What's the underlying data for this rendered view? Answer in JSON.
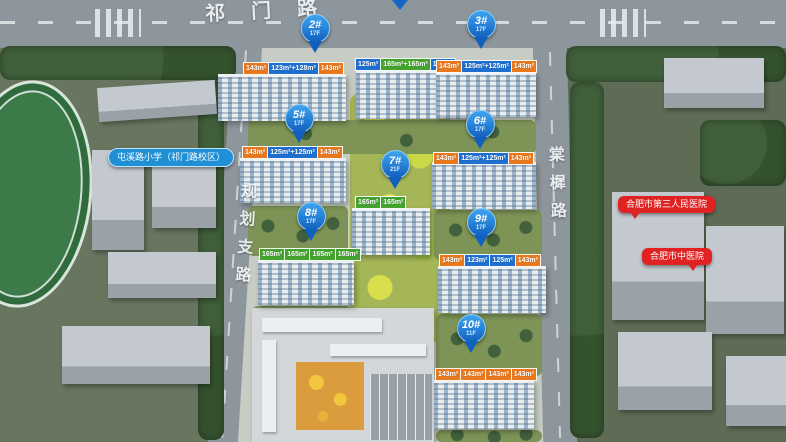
{
  "roads": {
    "top": "祁门路",
    "left": "规划支路",
    "right": "棠樨路"
  },
  "pois": {
    "school": "屯溪路小学（祁门路校区）",
    "hospital_1": "合肥市第三人民医院",
    "hospital_2": "合肥市中医院"
  },
  "buildings": [
    {
      "id": "1#",
      "tags": [
        {
          "text": "125m²",
          "color": "blue"
        },
        {
          "text": "165m²+165m²",
          "color": "green"
        },
        {
          "text": "125m²",
          "color": "blue"
        }
      ]
    },
    {
      "id": "2#",
      "floors": "17F",
      "tags": [
        {
          "text": "143m²",
          "color": "orange"
        },
        {
          "text": "123m²+128m²",
          "color": "blue"
        },
        {
          "text": "143m²",
          "color": "orange"
        }
      ]
    },
    {
      "id": "3#",
      "floors": "17F",
      "tags": [
        {
          "text": "143m²",
          "color": "orange"
        },
        {
          "text": "125m²+125m²",
          "color": "blue"
        },
        {
          "text": "143m²",
          "color": "orange"
        }
      ]
    },
    {
      "id": "5#",
      "floors": "17F",
      "tags": [
        {
          "text": "143m²",
          "color": "orange"
        },
        {
          "text": "125m²+125m²",
          "color": "blue"
        },
        {
          "text": "143m²",
          "color": "orange"
        }
      ]
    },
    {
      "id": "6#",
      "floors": "17F",
      "tags": [
        {
          "text": "143m²",
          "color": "orange"
        },
        {
          "text": "125m²+125m²",
          "color": "blue"
        },
        {
          "text": "143m²",
          "color": "orange"
        }
      ]
    },
    {
      "id": "7#",
      "floors": "21F",
      "tags": [
        {
          "text": "165m²",
          "color": "green"
        },
        {
          "text": "165m²",
          "color": "green"
        }
      ]
    },
    {
      "id": "8#",
      "floors": "17F",
      "tags": [
        {
          "text": "165m²",
          "color": "green"
        },
        {
          "text": "165m²",
          "color": "green"
        },
        {
          "text": "165m²",
          "color": "green"
        },
        {
          "text": "165m²",
          "color": "green"
        }
      ]
    },
    {
      "id": "9#",
      "floors": "17F",
      "tags": [
        {
          "text": "143m²",
          "color": "orange"
        },
        {
          "text": "123m²",
          "color": "blue"
        },
        {
          "text": "125m²",
          "color": "blue"
        },
        {
          "text": "143m²",
          "color": "orange"
        }
      ]
    },
    {
      "id": "10#",
      "floors": "11F",
      "tags": [
        {
          "text": "143m²",
          "color": "orange"
        },
        {
          "text": "143m²",
          "color": "orange"
        },
        {
          "text": "143m²",
          "color": "orange"
        },
        {
          "text": "143m²",
          "color": "orange"
        }
      ]
    }
  ],
  "colors": {
    "pin_blue": "#1160bd",
    "tag_blue": "#1e6fd0",
    "tag_orange": "#e8781e",
    "tag_green": "#43a32e",
    "poi_red": "#e02222",
    "poi_school_blue": "#1f8fd6",
    "road_gray": "#8e969d",
    "landscape_yellow_green": "#a4b657"
  }
}
